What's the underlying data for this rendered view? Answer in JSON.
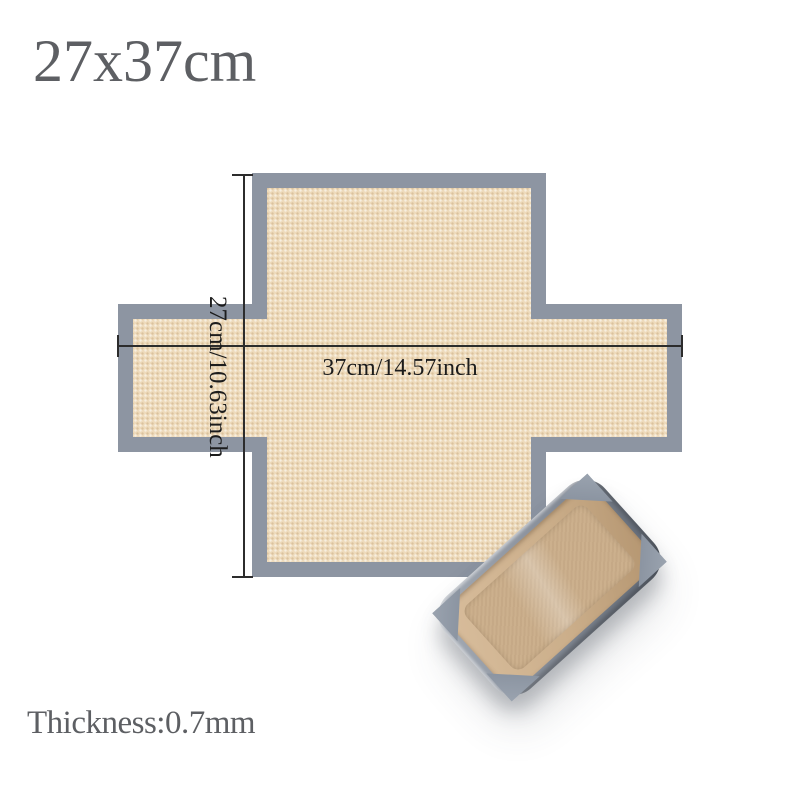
{
  "title": "27x37cm",
  "diagram": {
    "width_label": "37cm/14.57inch",
    "height_label": "27cm/10.63inch"
  },
  "footer": {
    "thickness_label": "Thickness:0.7mm"
  },
  "colors": {
    "background": "#ffffff",
    "heading_text": "#5d5f63",
    "dimension_text": "#1c1c1c",
    "dimension_line": "#2c2c2c",
    "mat_border_gray": "#8d95a2",
    "mat_surface_beige": "#eedbbc",
    "pan_metal_light": "#a6adb7",
    "pan_metal_dark": "#5f6773",
    "pan_liner_light": "#d8bd9c",
    "pan_liner_dark": "#b3946f",
    "pan_bottom_tan": "#ccb08d",
    "pan_flap_gray": "#8a93a0"
  }
}
